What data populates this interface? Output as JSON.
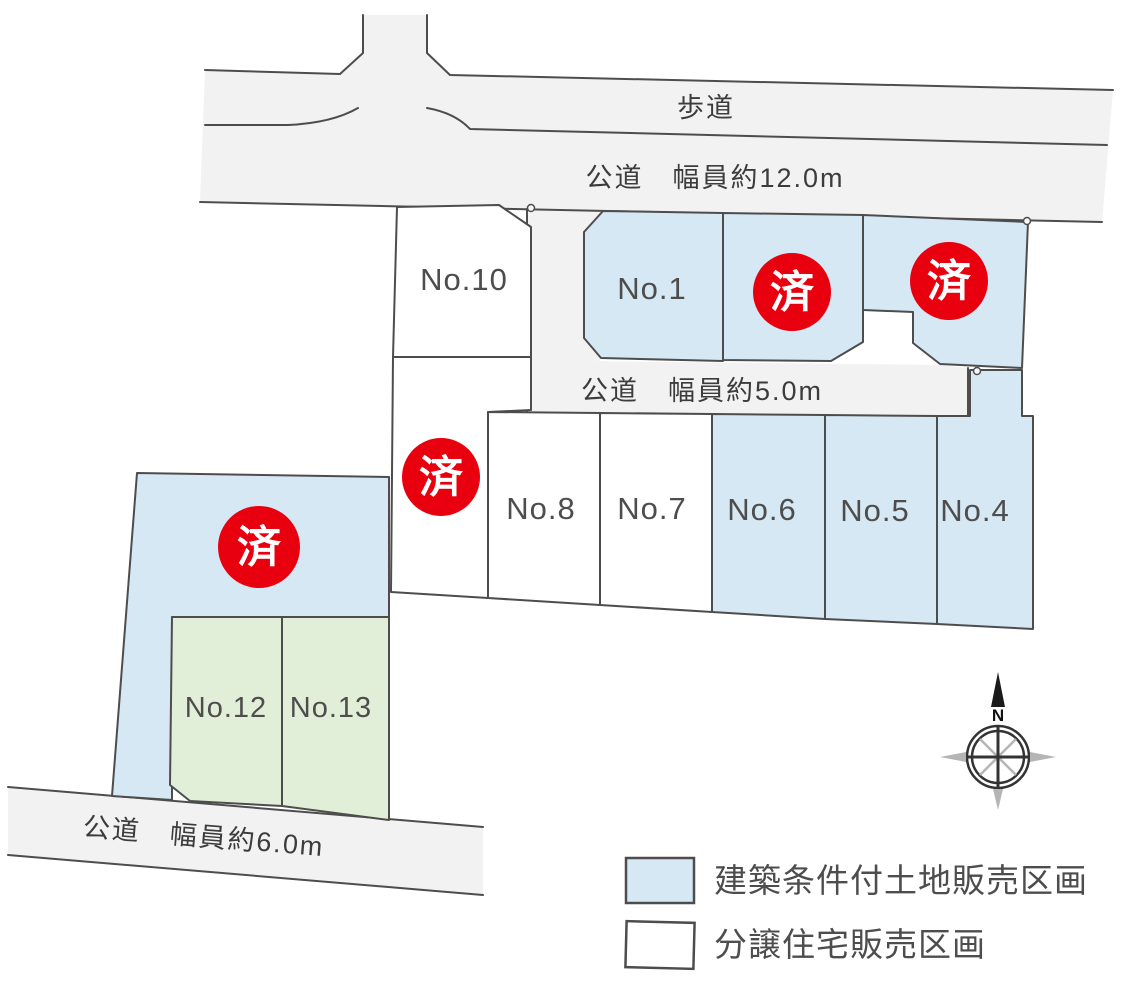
{
  "map": {
    "road_labels": {
      "sidewalk": "歩道",
      "road_12m": "公道　幅員約12.0m",
      "road_5m": "公道　幅員約5.0m",
      "road_6m": "公道　幅員約6.0m"
    },
    "lot_labels": {
      "no1": "No.1",
      "no4": "No.4",
      "no5": "No.5",
      "no6": "No.6",
      "no7": "No.7",
      "no8": "No.8",
      "no10": "No.10",
      "no12": "No.12",
      "no13": "No.13"
    },
    "sold_label": "済",
    "compass": {
      "north_label": "N"
    }
  },
  "legend": {
    "items": [
      {
        "label": "建築条件付土地販売区画",
        "color": "#d5e8f4"
      },
      {
        "label": "分譲住宅販売区画",
        "color": "#ffffff"
      }
    ]
  },
  "colors": {
    "lot_conditional": "#d5e8f4",
    "lot_house": "#ffffff",
    "lot_green": "#e2efd8",
    "road": "#f2f2f2",
    "sold_red": "#e8000f",
    "line": "#4d4d4d"
  }
}
